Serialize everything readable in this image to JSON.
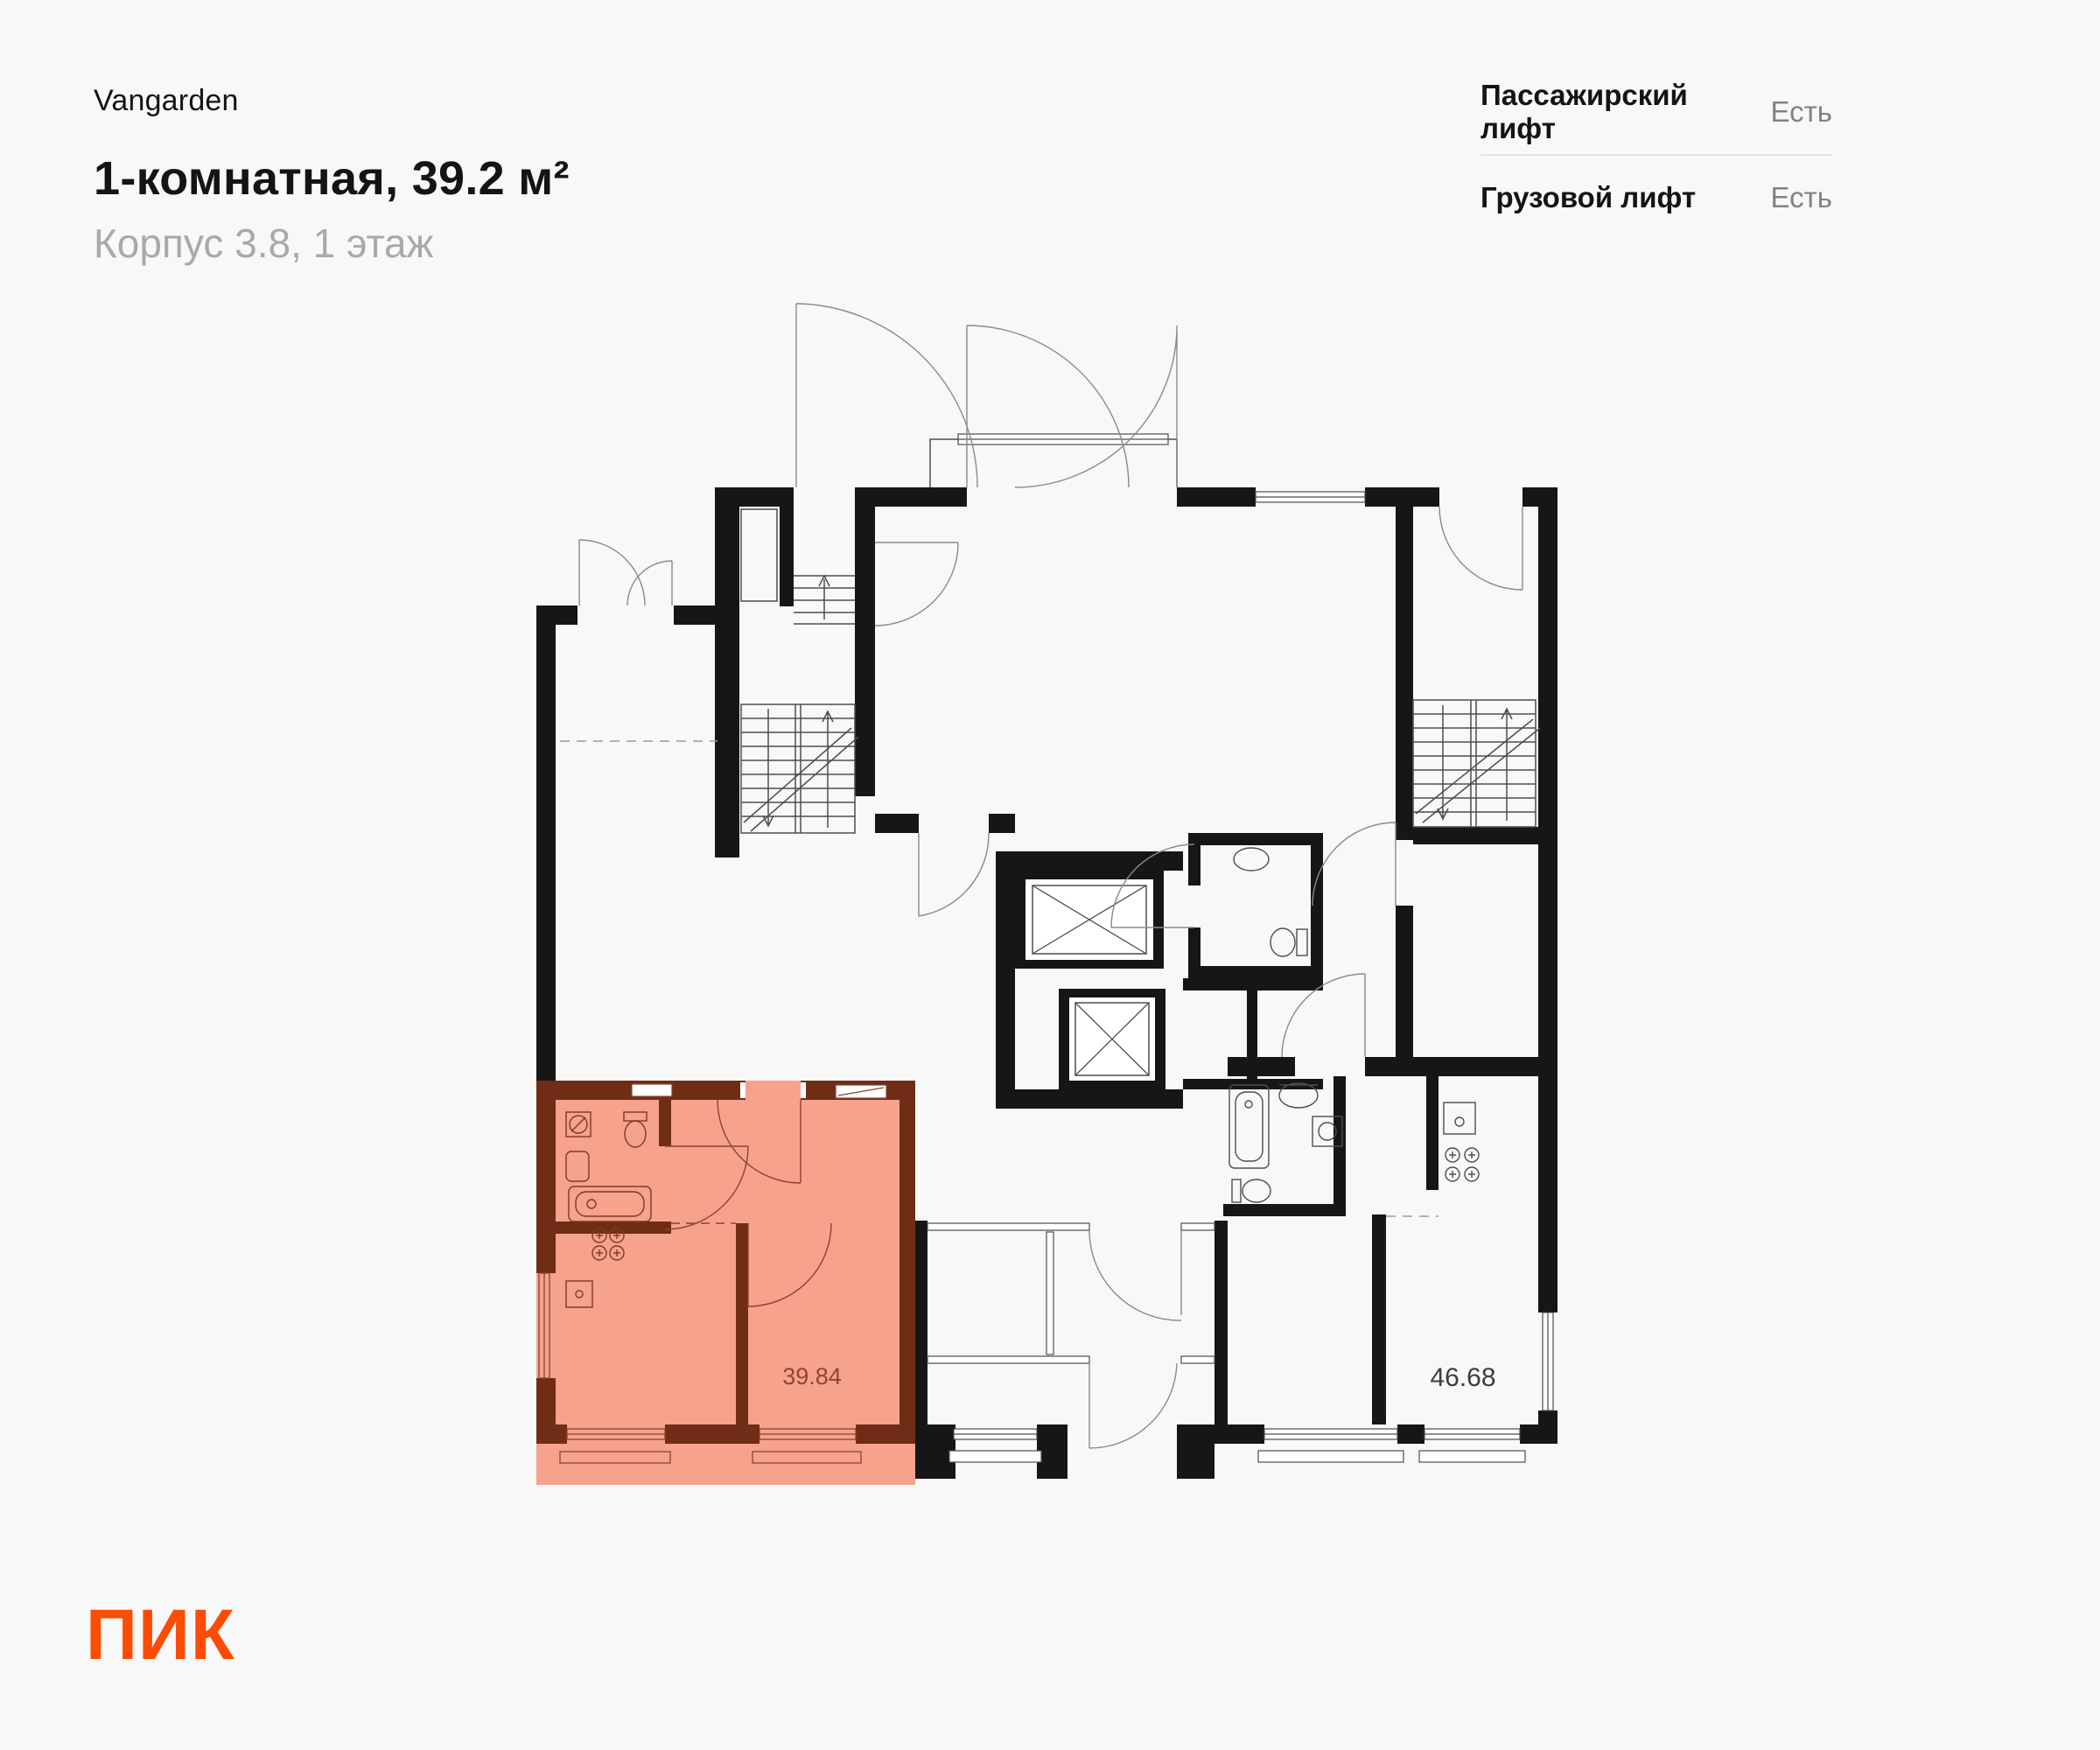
{
  "header": {
    "project": "Vangarden",
    "title": "1-комнатная, 39.2 м²",
    "subtitle": "Корпус 3.8, 1 этаж"
  },
  "lifts": {
    "rows": [
      {
        "label": "Пассажирский лифт",
        "value": "Есть"
      },
      {
        "label": "Грузовой лифт",
        "value": "Есть"
      }
    ]
  },
  "plan": {
    "highlighted_area_label": "39.84",
    "other_area_label": "46.68"
  },
  "logo": {
    "text": "ПИК"
  },
  "colors": {
    "accent": "#FC4C02",
    "wall": "#161616",
    "highlight_fill": "#F7A28D",
    "highlight_wall": "#6F2C16",
    "highlight_text": "#8C4734"
  }
}
